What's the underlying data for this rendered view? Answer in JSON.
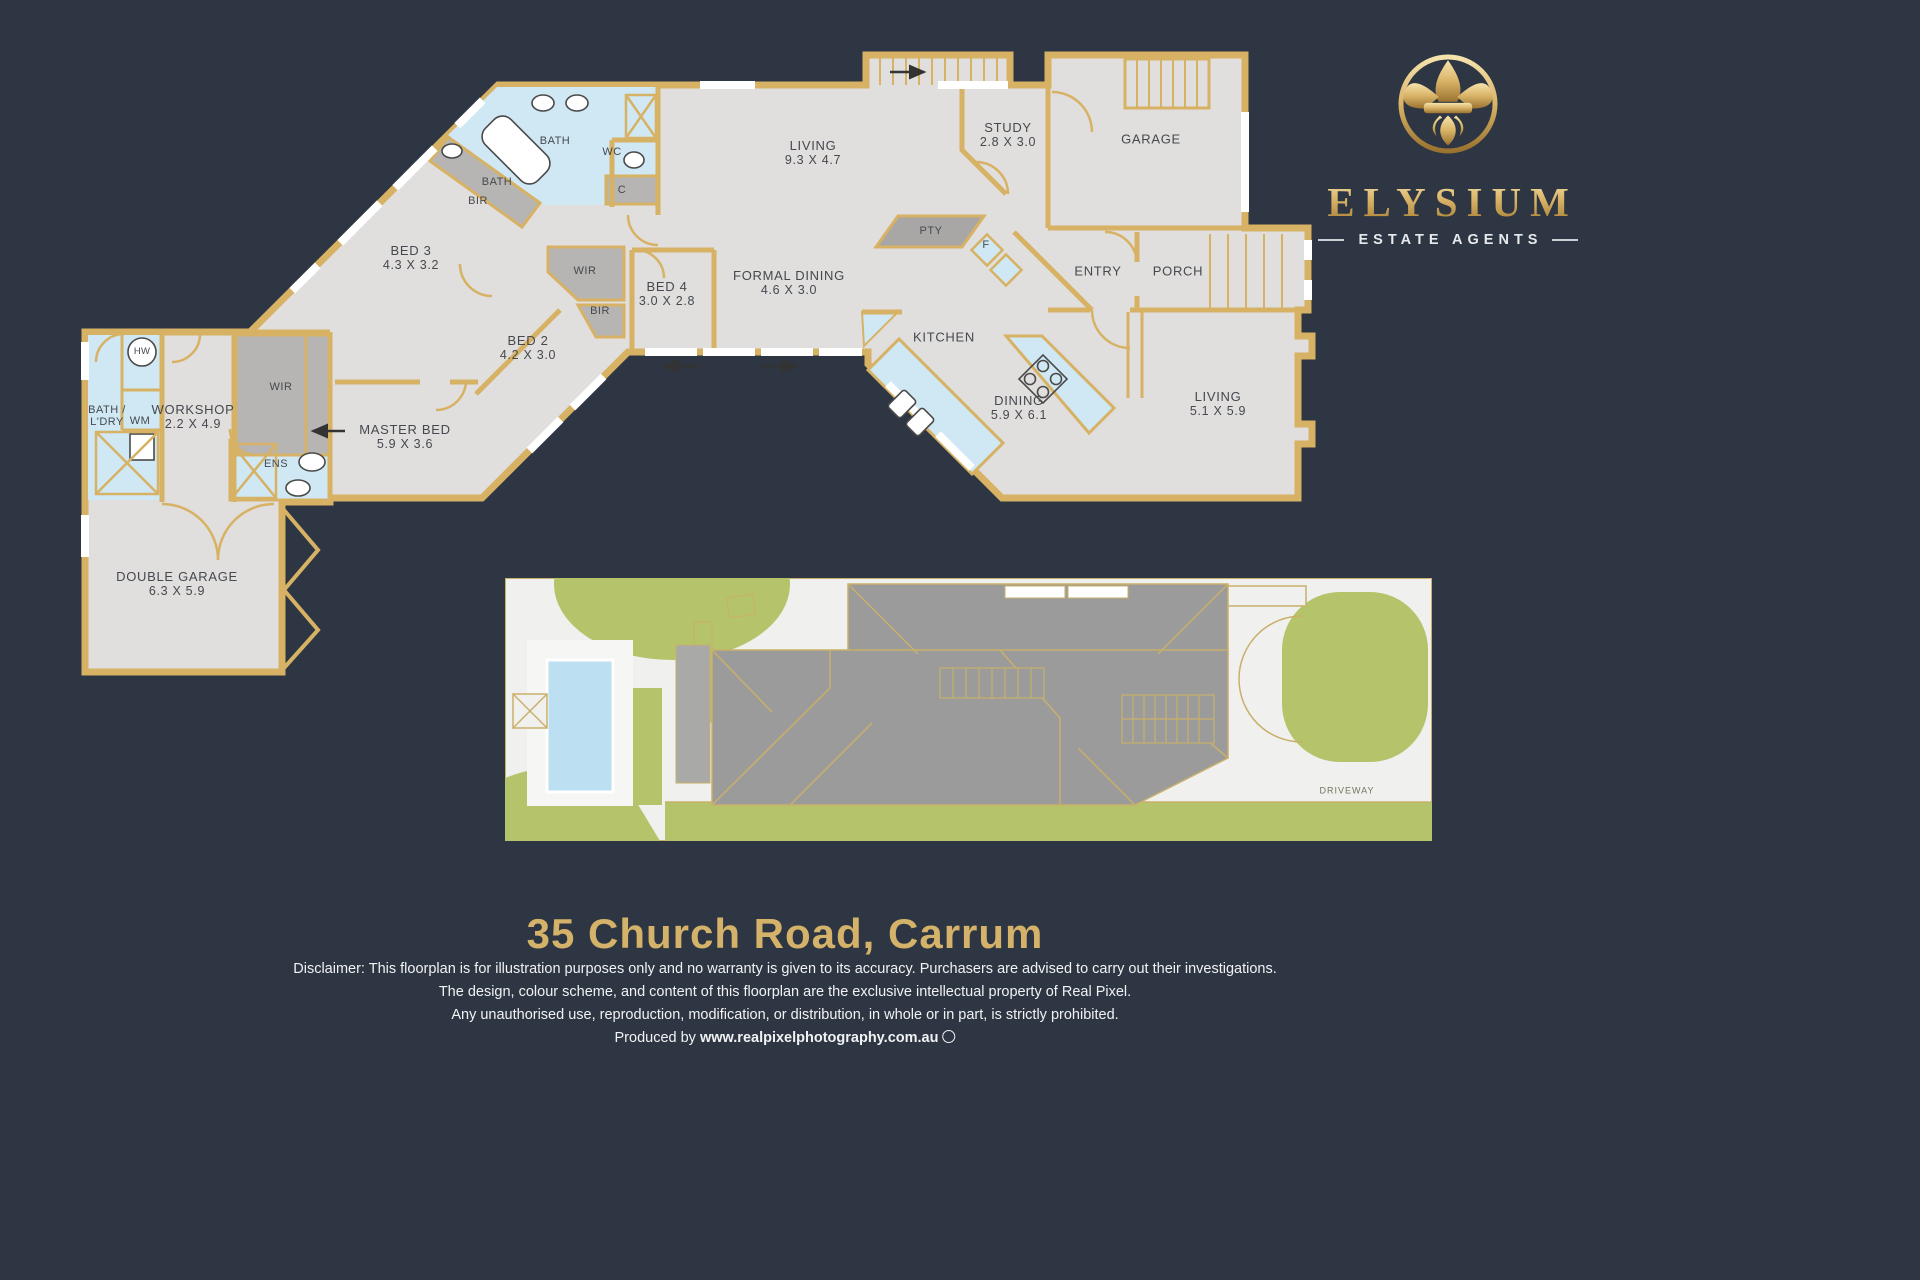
{
  "brand": {
    "name": "ELYSIUM",
    "tagline": "ESTATE AGENTS",
    "emblem": "fleur-de-lis"
  },
  "title": "35 Church Road, Carrum",
  "disclaimer": {
    "line1": "Disclaimer: This floorplan is for illustration purposes only and no warranty is given to its accuracy. Purchasers are advised to carry out their investigations.",
    "line2": "The design, colour scheme, and content of this floorplan are the exclusive intellectual property of Real Pixel.",
    "line3": "Any unauthorised use, reproduction, modification, or distribution, in whole or in part, is strictly prohibited.",
    "produced_prefix": "Produced by ",
    "produced_url": "www.realpixelphotography.com.au"
  },
  "floorplan": {
    "rooms": {
      "bath_top": {
        "name": "BATH"
      },
      "wc": {
        "name": "WC"
      },
      "c": {
        "name": "C"
      },
      "bath_left": {
        "name": "BATH"
      },
      "bir_bed3": {
        "name": "BIR"
      },
      "bed3": {
        "name": "BED 3",
        "dims": "4.3 X 3.2"
      },
      "wir_hall": {
        "name": "WIR"
      },
      "bir_bed2": {
        "name": "BIR"
      },
      "bed4": {
        "name": "BED 4",
        "dims": "3.0 X 2.8"
      },
      "formal_dining": {
        "name": "FORMAL DINING",
        "dims": "4.6 X 3.0"
      },
      "living_main": {
        "name": "LIVING",
        "dims": "9.3 X 4.7"
      },
      "study": {
        "name": "STUDY",
        "dims": "2.8 X 3.0"
      },
      "garage": {
        "name": "GARAGE"
      },
      "pty": {
        "name": "PTY"
      },
      "fridge": {
        "name": "F"
      },
      "entry": {
        "name": "ENTRY"
      },
      "porch": {
        "name": "PORCH"
      },
      "kitchen": {
        "name": "KITCHEN"
      },
      "dining": {
        "name": "DINING",
        "dims": "5.9 X 6.1"
      },
      "living_rear": {
        "name": "LIVING",
        "dims": "5.1 X 5.9"
      },
      "bed2": {
        "name": "BED 2",
        "dims": "4.2 X 3.0"
      },
      "master_bed": {
        "name": "MASTER BED",
        "dims": "5.9 X 3.6"
      },
      "ens": {
        "name": "ENS"
      },
      "wir_left": {
        "name": "WIR"
      },
      "workshop": {
        "name": "WORKSHOP",
        "dims": "2.2 X 4.9"
      },
      "bath_ldry": {
        "name": "BATH /",
        "dims": "L'DRY"
      },
      "wm": {
        "name": "WM"
      },
      "hw": {
        "name": "HW"
      },
      "double_garage": {
        "name": "DOUBLE GARAGE",
        "dims": "6.3 X 5.9"
      }
    }
  },
  "site_plan": {
    "driveway": "DRIVEWAY"
  },
  "colors": {
    "background": "#2d3642",
    "wall_gold": "#d7b264",
    "floor": "#e0dfdd",
    "wet_blue": "#cfe8f4",
    "storage_grey": "#b6b5b3",
    "site_green": "#b5c36b",
    "roof_grey": "#9b9b9b",
    "pool_blue": "#bcdff2",
    "site_ground": "#f0f0ee",
    "title_gold": "#d5b269",
    "logo_gold": "#d9b367"
  }
}
